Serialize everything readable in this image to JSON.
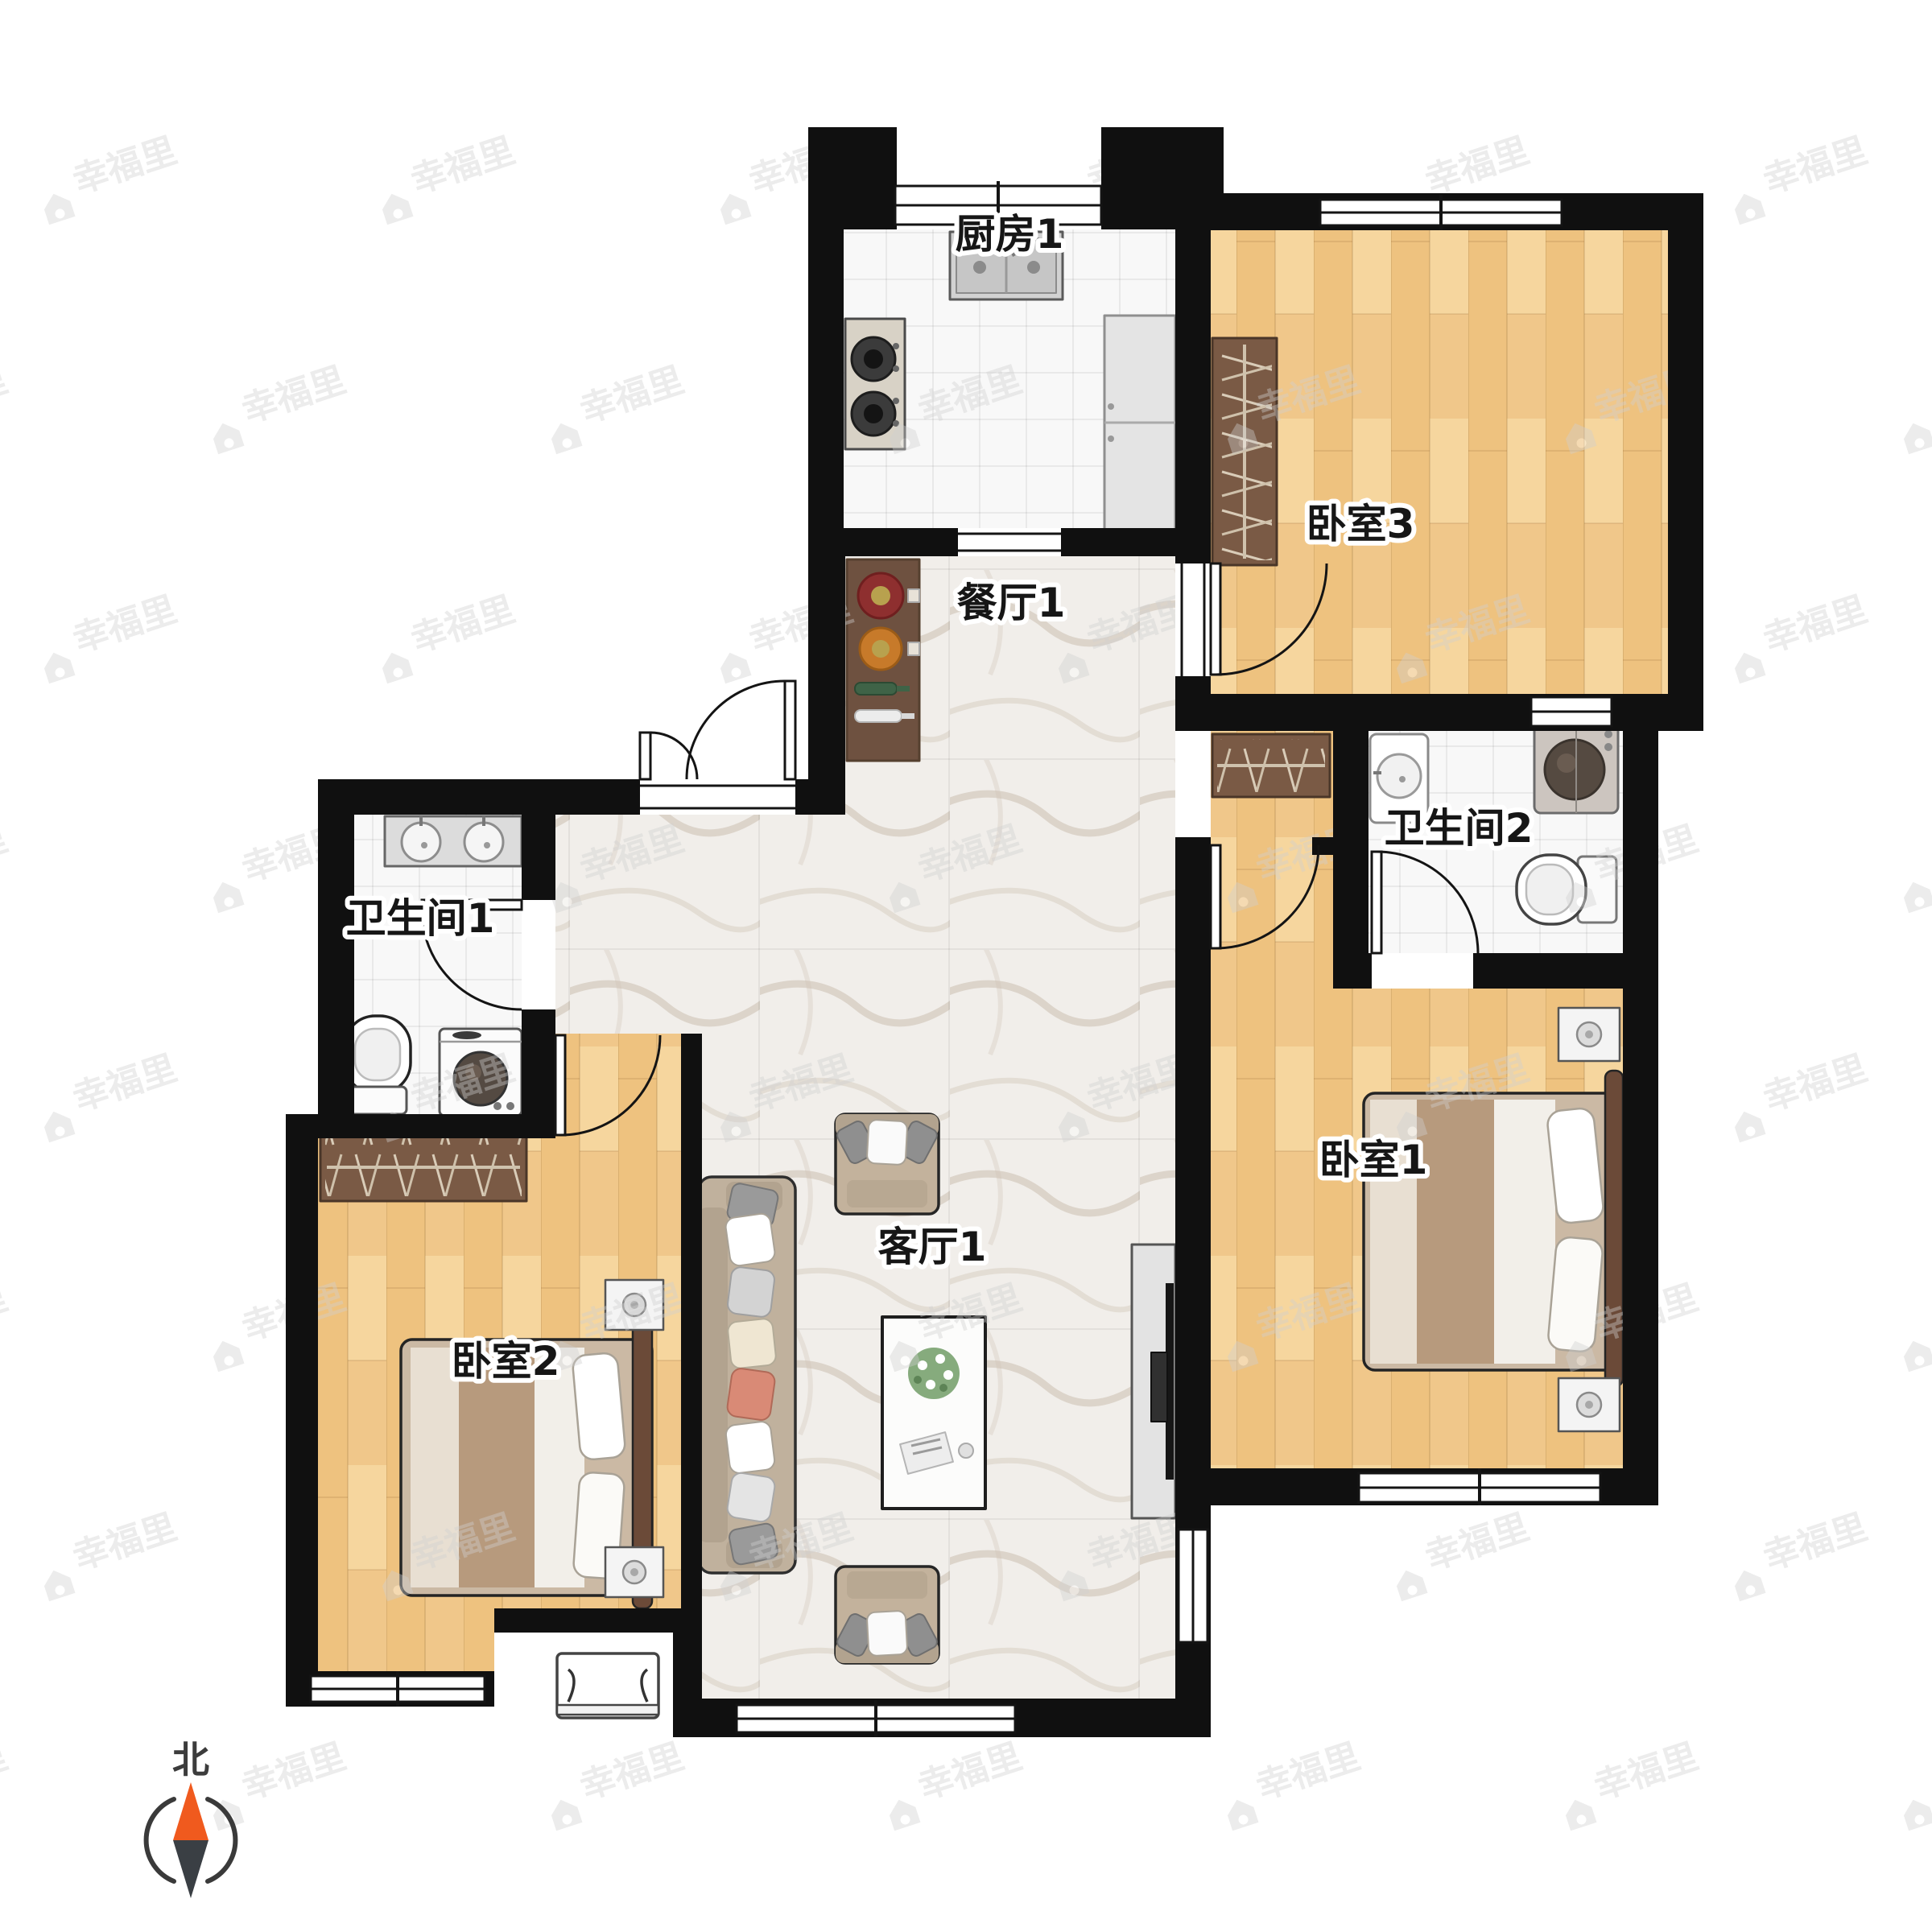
{
  "watermark": {
    "text": "幸福里"
  },
  "compass": {
    "label": "北",
    "north_color": "#f05a1e",
    "south_color": "#3a3f44"
  },
  "rooms": {
    "kitchen": {
      "label": "厨房1",
      "furniture": [
        "sink",
        "gas-stove",
        "fridge"
      ]
    },
    "bedroom3": {
      "label": "卧室3",
      "furniture": [
        "wardrobe"
      ]
    },
    "dining": {
      "label": "餐厅1",
      "furniture": [
        "sideboard"
      ]
    },
    "bathroom2": {
      "label": "卫生间2",
      "furniture": [
        "washbasin",
        "washing-machine",
        "toilet"
      ]
    },
    "bathroom1": {
      "label": "卫生间1",
      "furniture": [
        "double-washbasin",
        "toilet",
        "washing-machine"
      ]
    },
    "bedroom1": {
      "label": "卧室1",
      "furniture": [
        "wardrobe",
        "double-bed",
        "nightstand",
        "nightstand"
      ]
    },
    "living": {
      "label": "客厅1",
      "furniture": [
        "sofa",
        "armchair",
        "armchair",
        "coffee-table",
        "tv-cabinet"
      ]
    },
    "bedroom2": {
      "label": "卧室2",
      "furniture": [
        "wardrobe",
        "double-bed",
        "nightstand",
        "nightstand",
        "air-conditioner"
      ]
    }
  },
  "colors": {
    "wall": "#101010",
    "wood_floor": "#f0c98c",
    "marble_floor": "#f1eeea",
    "tile_floor": "#f8f8f8",
    "wardrobe": "#7a5a45",
    "compass_north": "#f05a1e"
  }
}
